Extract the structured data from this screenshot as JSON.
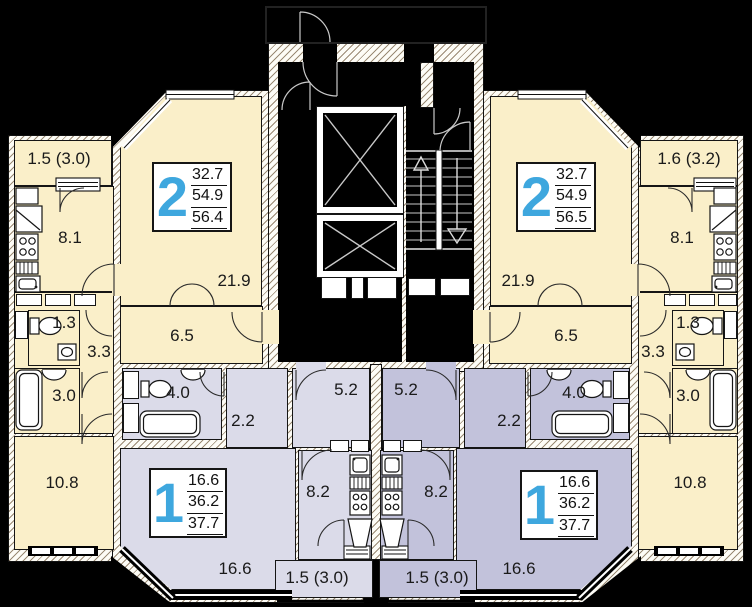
{
  "colors": {
    "apartment_2room_fill": "#FAEFC9",
    "apartment_1room_left_fill": "#DBDBE9",
    "apartment_1room_right_fill": "#C2C2DB",
    "apartment_number_accent": "#3EA7DE",
    "wall_hatch_line": "#9A8A74",
    "outline": "#111111",
    "background": "#000000"
  },
  "rooms": {
    "balcony_tl": "1.5 (3.0)",
    "kitchen_tl": "8.1",
    "living2_left": "21.9",
    "hall2_left": "6.5",
    "wc_left": "1.3",
    "hall3_left": "3.3",
    "bath3_left": "3.0",
    "room108_left": "10.8",
    "bath4_left": "4.0",
    "hall22_left": "2.2",
    "corr52_left": "5.2",
    "kitchen82_left": "8.2",
    "living1_left": "16.6",
    "balcony_bl": "1.5 (3.0)",
    "balcony_tr": "1.6 (3.2)",
    "kitchen_tr": "8.1",
    "living2_right": "21.9",
    "hall2_right": "6.5",
    "wc_right": "1.3",
    "hall3_right": "3.3",
    "bath3_right": "3.0",
    "room108_right": "10.8",
    "bath4_right": "4.0",
    "hall22_right": "2.2",
    "corr52_right": "5.2",
    "kitchen82_right": "8.2",
    "living1_right": "16.6",
    "balcony_br": "1.5 (3.0)"
  },
  "cards": {
    "apt2_left": {
      "num": "2",
      "living": "32.7",
      "area": "54.9",
      "total": "56.4"
    },
    "apt2_right": {
      "num": "2",
      "living": "32.7",
      "area": "54.9",
      "total": "56.5"
    },
    "apt1_left": {
      "num": "1",
      "living": "16.6",
      "area": "36.2",
      "total": "37.7"
    },
    "apt1_right": {
      "num": "1",
      "living": "16.6",
      "area": "36.2",
      "total": "37.7"
    }
  },
  "icons": [
    "elevator-shaft-x-icon",
    "stairs-up-arrow-icon",
    "stairs-down-arrow-icon",
    "door-arc-icon",
    "toilet-icon",
    "bathtub-icon",
    "sink-icon",
    "stove-burners-icon",
    "kitchen-sink-icon",
    "vent-icon",
    "fridge-icon",
    "window-icon"
  ]
}
